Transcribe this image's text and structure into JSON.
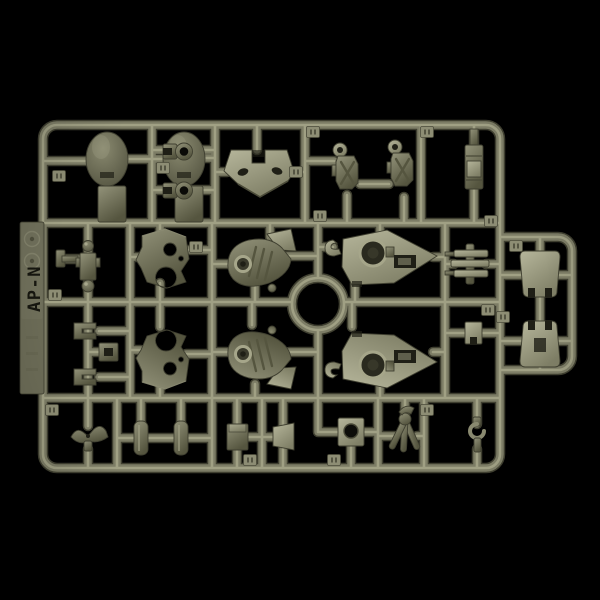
{
  "sprue": {
    "label": "AP-N",
    "mold_marks": [
      "recycle-mark-icon",
      "recycle-mark-icon"
    ],
    "central_ring": true,
    "parts": [
      {
        "name": "dome-armor",
        "count": 2
      },
      {
        "name": "flat-tab-plate",
        "count": 2
      },
      {
        "name": "ring-clip",
        "count": 2
      },
      {
        "name": "chest-plate",
        "count": 1
      },
      {
        "name": "joint-block",
        "count": 2
      },
      {
        "name": "slim-block",
        "count": 1
      },
      {
        "name": "double-ball-joint",
        "count": 1
      },
      {
        "name": "frame-plate",
        "count": 2
      },
      {
        "name": "curved-vent-armor",
        "count": 2
      },
      {
        "name": "pointed-shield",
        "count": 2
      },
      {
        "name": "piston-greeble",
        "count": 1
      },
      {
        "name": "shin-plate",
        "count": 2
      },
      {
        "name": "u-clip",
        "count": 2
      },
      {
        "name": "socket-block",
        "count": 1
      },
      {
        "name": "crest-part",
        "count": 1
      },
      {
        "name": "cylinder-part",
        "count": 2
      },
      {
        "name": "wedge-block",
        "count": 2
      },
      {
        "name": "square-socket-plate",
        "count": 1
      },
      {
        "name": "tripod-claw",
        "count": 1
      },
      {
        "name": "hook-part",
        "count": 1
      },
      {
        "name": "part-number-tag",
        "count": 16
      }
    ]
  },
  "colors": {
    "bg": "#000000",
    "runner-dk": "#3f3f30",
    "runner-md": "#7d7d66",
    "runner-hi": "#a6a68a",
    "plate-hi": "#b6b69b",
    "plate-lo": "#808067",
    "armor-hi": "#93937a",
    "armor-lo": "#55553f",
    "dome-hi": "#8a8a70",
    "dome-lo": "#4a4a38",
    "recess": "#1f1f16",
    "tab": "#6c6c57",
    "label-ink": "#16160f"
  }
}
